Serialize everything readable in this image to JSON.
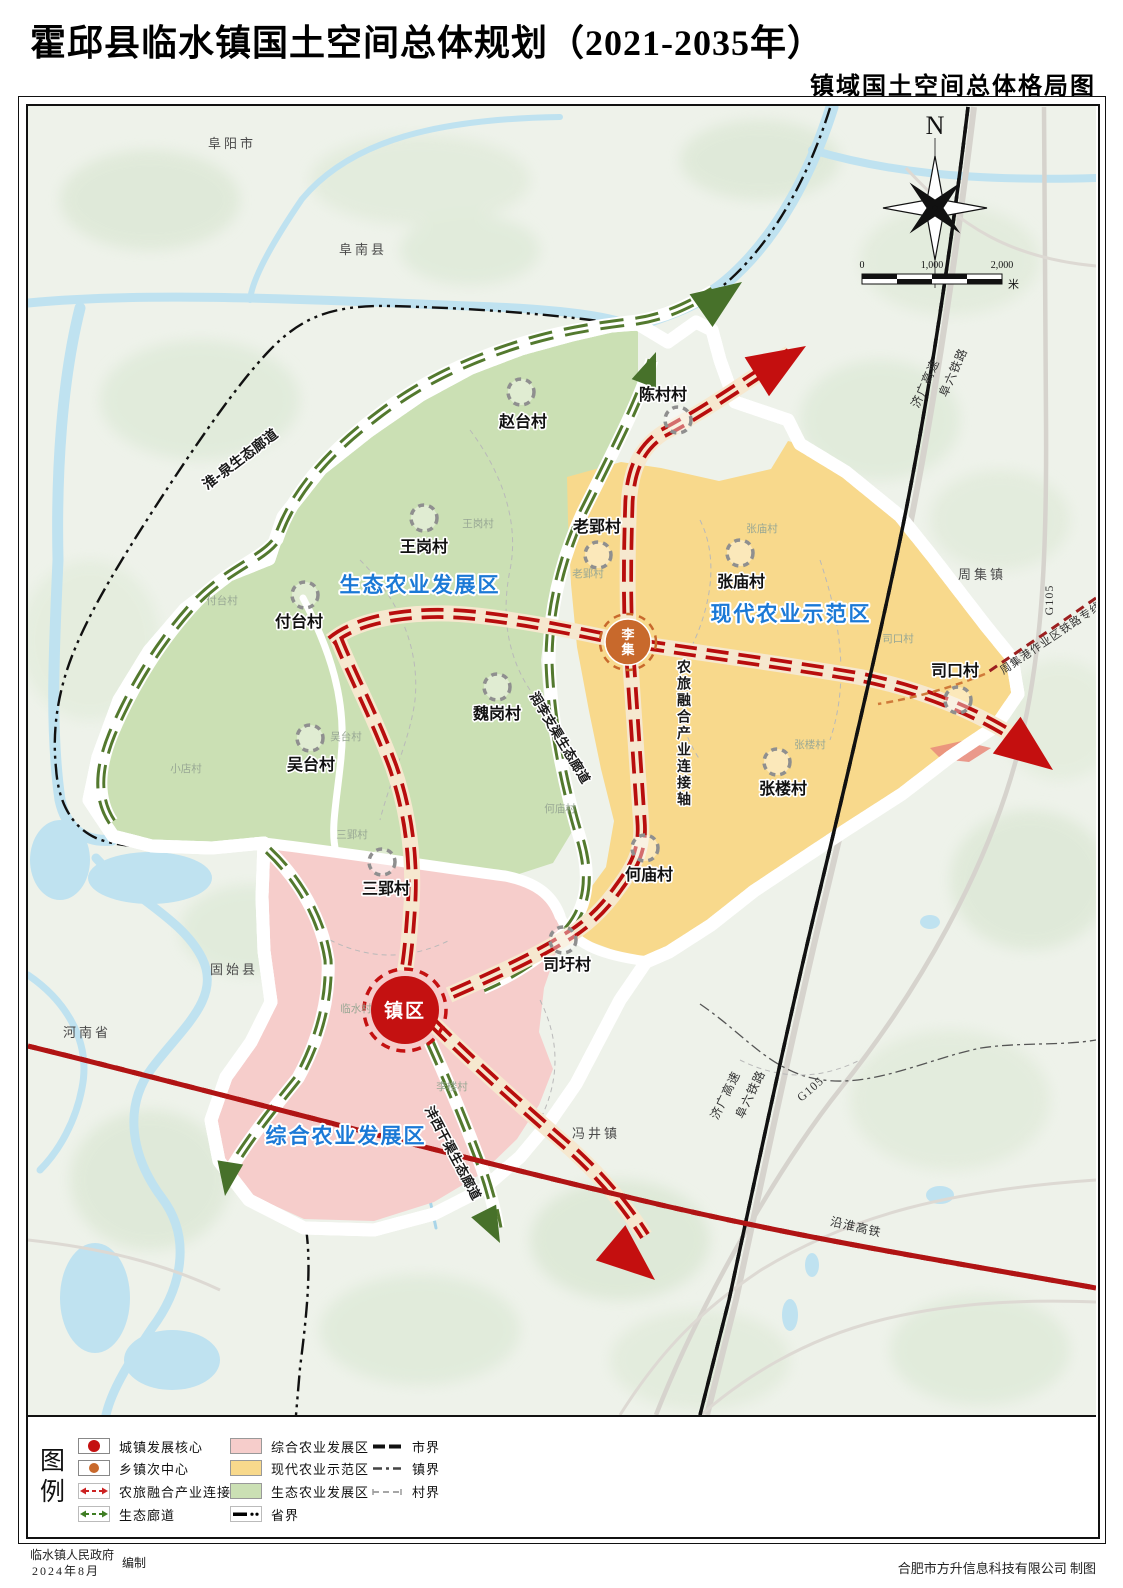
{
  "title": "霍邱县临水镇国土空间总体规划（2021-2035年）",
  "subtitle": "镇域国土空间总体格局图",
  "compass": {
    "north": "N"
  },
  "scalebar": {
    "t0": "0",
    "t1": "1,000",
    "t2": "2,000",
    "unit": "米"
  },
  "region_labels": {
    "eco": "生态农业发展区",
    "modern": "现代农业示范区",
    "comprehensive": "综合农业发展区"
  },
  "centers": {
    "town": "镇区",
    "liji": "李集"
  },
  "villages": {
    "zhaotai": "赵台村",
    "chencun": "陈村村",
    "wanggang": "王岗村",
    "futai": "付台村",
    "laoying": "老郢村",
    "zhangmiao": "张庙村",
    "sikou": "司口村",
    "weigang": "魏岗村",
    "wutai": "吴台村",
    "zhanglou": "张楼村",
    "sanying": "三郢村",
    "hemiao": "何庙村",
    "siwei": "司圩村"
  },
  "faint_labels": {
    "xiaodian": "小店村",
    "linshui": "临水村",
    "lilou": "李楼村",
    "sanying": "三郢村",
    "laoying": "老郢村",
    "hemiao": "何庙村",
    "sikou": "司口村",
    "zhanglou": "张楼村",
    "zhangmiao": "张庙村",
    "wutai": "吴台村",
    "wanggang": "王岗村",
    "futai": "付台村"
  },
  "neighbors": {
    "fuyang": "阜阳市",
    "funan": "阜南县",
    "gushi": "固始县",
    "henan": "河南省",
    "fengjing": "冯井镇",
    "zhouji": "周集镇"
  },
  "corridors": {
    "huaiquan": "淮-泉生态廊道",
    "runli": "润李支渠生态廊道",
    "fengxi": "沣西干渠生态廊道",
    "axis": "农旅融合产业连接轴"
  },
  "transport": {
    "jiguang": "济广高速",
    "fuliu": "阜六铁路",
    "g105": "G105",
    "yanhuai": "沿淮高铁",
    "zhouji_rail": "周集港作业区铁路专线"
  },
  "legend": {
    "heading": "图例",
    "core": "城镇发展核心",
    "subcenter": "乡镇次中心",
    "axis": "农旅融合产业连接轴",
    "eco_corridor": "生态廊道",
    "zone_comprehensive": "综合农业发展区",
    "zone_modern": "现代农业示范区",
    "zone_eco": "生态农业发展区",
    "province": "省界",
    "city": "市界",
    "town": "镇界",
    "village": "村界"
  },
  "credits": {
    "left_org": "临水镇人民政府",
    "left_date": "2024年8月",
    "left_role": "编制",
    "right": "合肥市方升信息科技有限公司 制图"
  },
  "colors": {
    "zone_eco": "#cbe0b4",
    "zone_modern": "#f8d98c",
    "zone_comprehensive": "#f6cdcb",
    "axis_red": "#b80d0d",
    "corridor_green": "#53792e",
    "label_blue": "#1b79d6",
    "water": "#bfe2f0",
    "boundary_magenta": "#ff3ce0",
    "subcenter_orange": "#c8692c",
    "core_red": "#c41111"
  }
}
